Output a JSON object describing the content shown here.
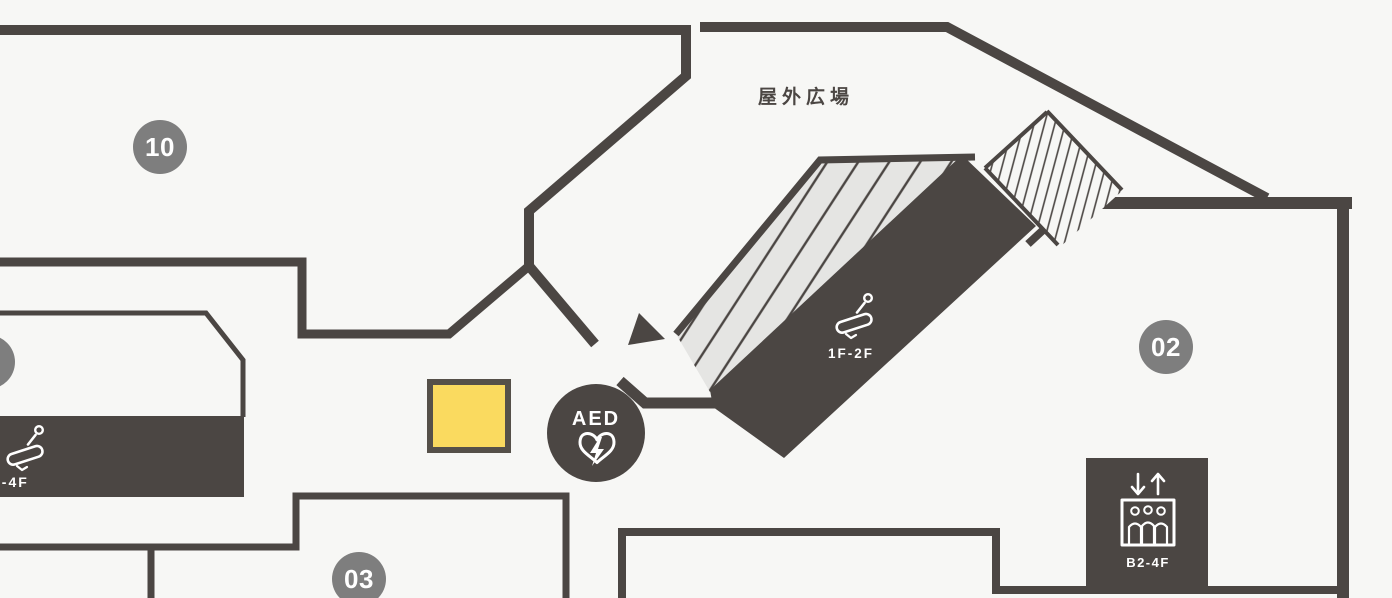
{
  "floor_map": {
    "plaza_label": "屋外広場",
    "badges": {
      "b10": {
        "label": "10"
      },
      "b02": {
        "label": "02"
      },
      "b03": {
        "label": "03"
      },
      "b_left_partial": {
        "label": ""
      }
    },
    "aed": {
      "label": "AED"
    },
    "escalator_center": {
      "label": "1F-2F"
    },
    "escalator_left": {
      "label": "2-4F"
    },
    "elevator": {
      "label": "B2-4F"
    },
    "colors": {
      "background": "#f7f7f5",
      "wall": "#4b4643",
      "badge": "#7e7e7e",
      "highlight_fill": "#fada5f",
      "highlight_border": "#555049",
      "stairs_fill": "#e5e5e3"
    }
  }
}
